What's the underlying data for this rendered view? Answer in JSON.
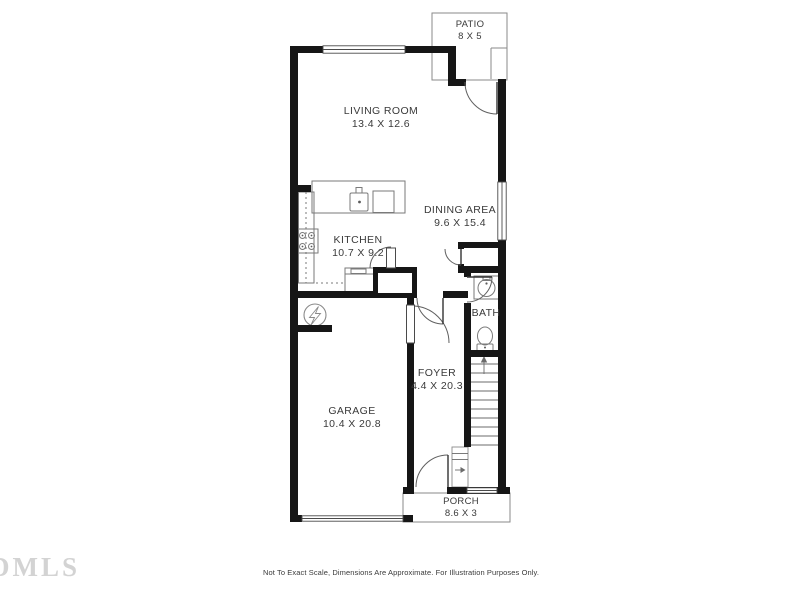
{
  "floor_plan": {
    "rooms": [
      {
        "name": "PATIO",
        "dims": "8 X 5"
      },
      {
        "name": "LIVING ROOM",
        "dims": "13.4 X 12.6"
      },
      {
        "name": "DINING AREA",
        "dims": "9.6 X 15.4"
      },
      {
        "name": "KITCHEN",
        "dims": "10.7 X 9.2"
      },
      {
        "name": "BATH",
        "dims": ""
      },
      {
        "name": "FOYER",
        "dims": "4.4 X 20.3"
      },
      {
        "name": "GARAGE",
        "dims": "10.4 X 20.8"
      },
      {
        "name": "PORCH",
        "dims": "8.6 X 3"
      }
    ],
    "fixtures": [
      "kitchen-sink",
      "refrigerator",
      "range-cooktop",
      "counter-dishwasher",
      "pantry-closet",
      "entry-closet",
      "bath-sink",
      "toilet",
      "staircase-up",
      "electrical-panel",
      "living-room-window",
      "dining-window",
      "porch-window",
      "garage-door"
    ],
    "disclaimer": "Not To Exact Scale, Dimensions Are Approximate. For Illustration Purposes Only.",
    "watermark": "DMLS",
    "colors": {
      "wall": "#161616",
      "thin_line": "#7a7a7a",
      "door_line": "#5f5f5f",
      "label_text": "#3a3a3a",
      "watermark": "#cccccc",
      "background": "#ffffff"
    }
  }
}
